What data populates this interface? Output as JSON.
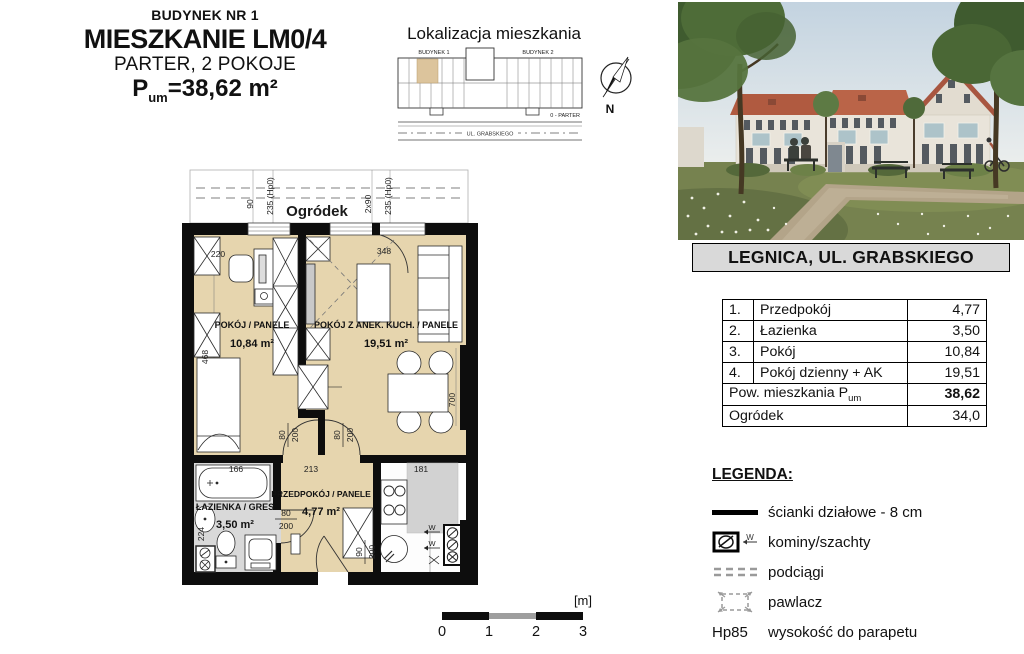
{
  "palette": {
    "floor_tan": "#e6d5ae",
    "bath_gray": "#d9d9d9",
    "wall_black": "#0d0d0d",
    "header_gray": "#d9d9d9",
    "roof_red": "#b05a40"
  },
  "header": {
    "line1": "BUDYNEK NR 1",
    "line2": "MIESZKANIE LM0/4",
    "line3": "PARTER, 2 POKOJE",
    "area_p": "P",
    "area_sub": "um",
    "area_rest": "=38,62 m²"
  },
  "localization": {
    "title": "Lokalizacja mieszkania",
    "building1": "BUDYNEK 1",
    "building2": "BUDYNEK 2",
    "floor_note": "0 - PARTER",
    "street": "UL. GRABSKIEGO",
    "north": "N"
  },
  "plan": {
    "garden": "Ogródek",
    "room1_name": "POKÓJ / PANELE",
    "room1_area": "10,84 m²",
    "room2_name": "POKÓJ Z ANEK. KUCH. / PANELE",
    "room2_area": "19,51 m²",
    "bath_name": "ŁAZIENKA / GRES",
    "bath_area": "3,50 m²",
    "hall_name": "PRZEDPOKÓJ / PANELE",
    "hall_area": "4,77 m²",
    "dims": {
      "d90": "90",
      "d235": "235 (Hp0)",
      "d2x90": "2x90",
      "d220": "220",
      "d348": "348",
      "d468": "468",
      "d700": "700",
      "d166": "166",
      "d224": "224",
      "d213": "213",
      "d181": "181",
      "d80": "80",
      "d200": "200",
      "w": "W"
    }
  },
  "address_bar": "LEGNICA, UL. GRABSKIEGO",
  "table": {
    "rows": [
      {
        "no": "1.",
        "name": "Przedpokój",
        "value": "4,77"
      },
      {
        "no": "2.",
        "name": "Łazienka",
        "value": "3,50"
      },
      {
        "no": "3.",
        "name": "Pokój",
        "value": "10,84"
      },
      {
        "no": "4.",
        "name": "Pokój dzienny + AK",
        "value": "19,51"
      }
    ],
    "total_label": "Pow. mieszkania P",
    "total_sub": "um",
    "total_value": "38,62",
    "garden_label": "Ogródek",
    "garden_value": "34,0"
  },
  "legend": {
    "title": "LEGENDA:",
    "w_mark": "W",
    "items": [
      {
        "label": "ścianki działowe - 8 cm"
      },
      {
        "label": "kominy/szachty"
      },
      {
        "label": "podciągi"
      },
      {
        "label": "pawlacz"
      },
      {
        "symbol": "Hp85",
        "label": "wysokość do parapetu"
      }
    ]
  },
  "scalebar": {
    "unit": "[m]",
    "t0": "0",
    "t1": "1",
    "t2": "2",
    "t3": "3"
  }
}
